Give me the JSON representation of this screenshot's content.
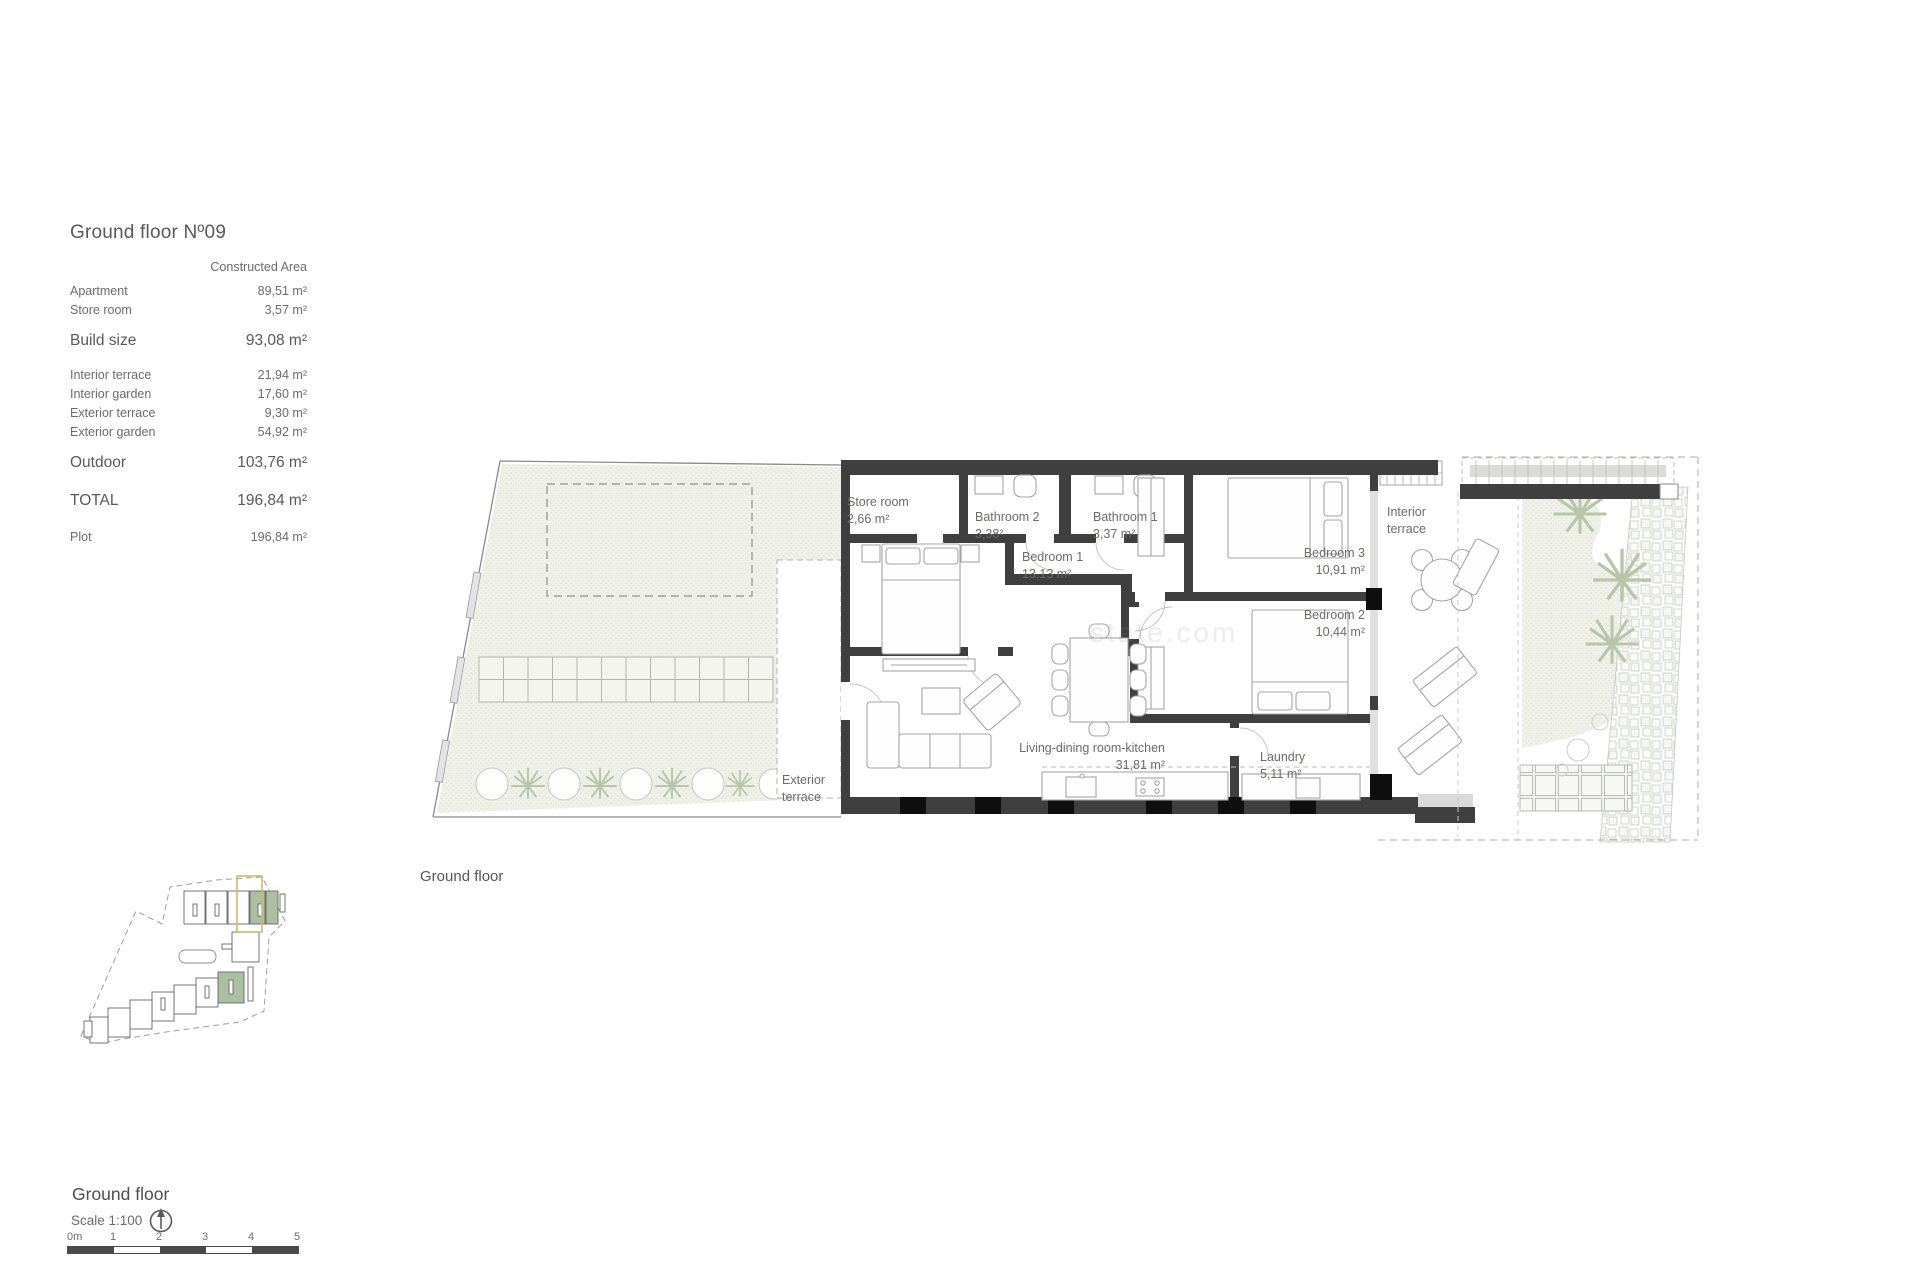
{
  "info_panel": {
    "title": "Ground floor Nº09",
    "column_header": "Constructed Area",
    "rows": [
      {
        "label": "Apartment",
        "value": "89,51 m²"
      },
      {
        "label": "Store room",
        "value": "3,57 m²"
      },
      {
        "label": "Build size",
        "value": "93,08 m²"
      },
      {
        "label": "Interior terrace",
        "value": "21,94 m²"
      },
      {
        "label": "Interior garden",
        "value": "17,60 m²"
      },
      {
        "label": "Exterior terrace",
        "value": "9,30 m²"
      },
      {
        "label": "Exterior garden",
        "value": "54,92 m²"
      },
      {
        "label": "Outdoor",
        "value": "103,76 m²"
      },
      {
        "label": "TOTAL",
        "value": "196,84 m²"
      },
      {
        "label": "Plot",
        "value": "196,84 m²"
      }
    ]
  },
  "plan": {
    "caption": "Ground floor",
    "watermark": "state.com",
    "rooms": {
      "store_room": {
        "name": "Store room",
        "area": "2,66 m²"
      },
      "bathroom_2": {
        "name": "Bathroom 2",
        "area": "3,38²"
      },
      "bathroom_1": {
        "name": "Bathroom 1",
        "area": "3,37 m²"
      },
      "bedroom_1": {
        "name": "Bedroom 1",
        "area": "13,13 m²"
      },
      "bedroom_3": {
        "name": "Bedroom 3",
        "area": "10,91 m²"
      },
      "bedroom_2": {
        "name": "Bedroom 2",
        "area": "10,44 m²"
      },
      "living": {
        "name": "Living-dining room-kitchen",
        "area": "31,81 m²"
      },
      "laundry": {
        "name": "Laundry",
        "area": "5,11 m²"
      },
      "interior_terrace": {
        "line1": "Interior",
        "line2": "terrace"
      },
      "exterior_terrace": {
        "line1": "Exterior",
        "line2": "terrace"
      }
    }
  },
  "footer": {
    "title": "Ground floor",
    "scale_label": "Scale 1:100",
    "scale_bar": [
      "0m",
      "1",
      "2",
      "3",
      "4",
      "5"
    ]
  },
  "colors": {
    "wall": "#3f3f3f",
    "pillar": "#0f0f0f",
    "text_gray": "#6b6b6b",
    "garden_hatch_base": "#eff1e9",
    "site_unit_green": "#abc0a1",
    "site_highlight_yellow": "#cdb96a"
  }
}
